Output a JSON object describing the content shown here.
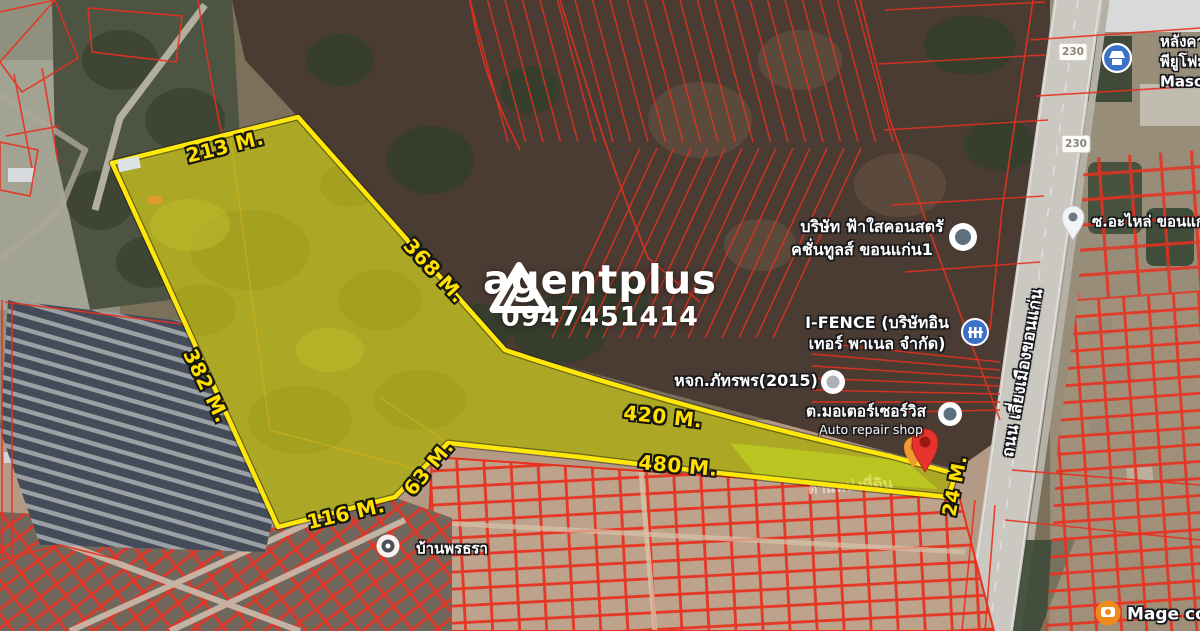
{
  "watermark": {
    "brand": "agentplus",
    "phone": "0947451414",
    "logo": "triangle-a-logo"
  },
  "dimensions": {
    "top_edge": "213 M.",
    "northeast_edge": "368 M.",
    "west_edge": "382 M.",
    "strip_upper": "420 M.",
    "strip_lower": "480 M.",
    "notch_edge": "63 M.",
    "south_edge": "116 M.",
    "road_frontage": "24 M."
  },
  "road": {
    "name": "ถนน เลี่ยงเมืองขอนแก่น",
    "route_number": "230"
  },
  "places": {
    "construction_company_line1": "บริษัท ฟ้าใสคอนสตรั",
    "construction_company_line2": "คชั่นทูลส์ ขอนแก่น1",
    "ifence_line1": "I-FENCE (บริษัทอิน",
    "ifence_line2": "เทอร์ พาเนล จำกัด)",
    "phatraporn": "หจก.ภัทรพร(2015)",
    "motor_service": "ต.มอเตอร์เซอร์วิส",
    "motor_service_sub": "Auto repair shop",
    "soi_alai": "ซ.อะไหล่ ขอนแก่น",
    "masonry_line1": "หลังคาเ",
    "masonry_line2": "พียูโฟม",
    "masonry_line3": "Masonry",
    "ban_porn": "บ้านพรธรา",
    "land_position": "ตำแหน่งที่ดิน"
  },
  "attribution": "Mage co",
  "colors": {
    "boundary_yellow": "#ffe70a",
    "parcel_overlay": "#f5eb00",
    "cadastral_red": "#e8301f",
    "pin_red": "#e8332c",
    "marker_blue": "#3b72c8",
    "dimension_text": "#ffe000"
  }
}
